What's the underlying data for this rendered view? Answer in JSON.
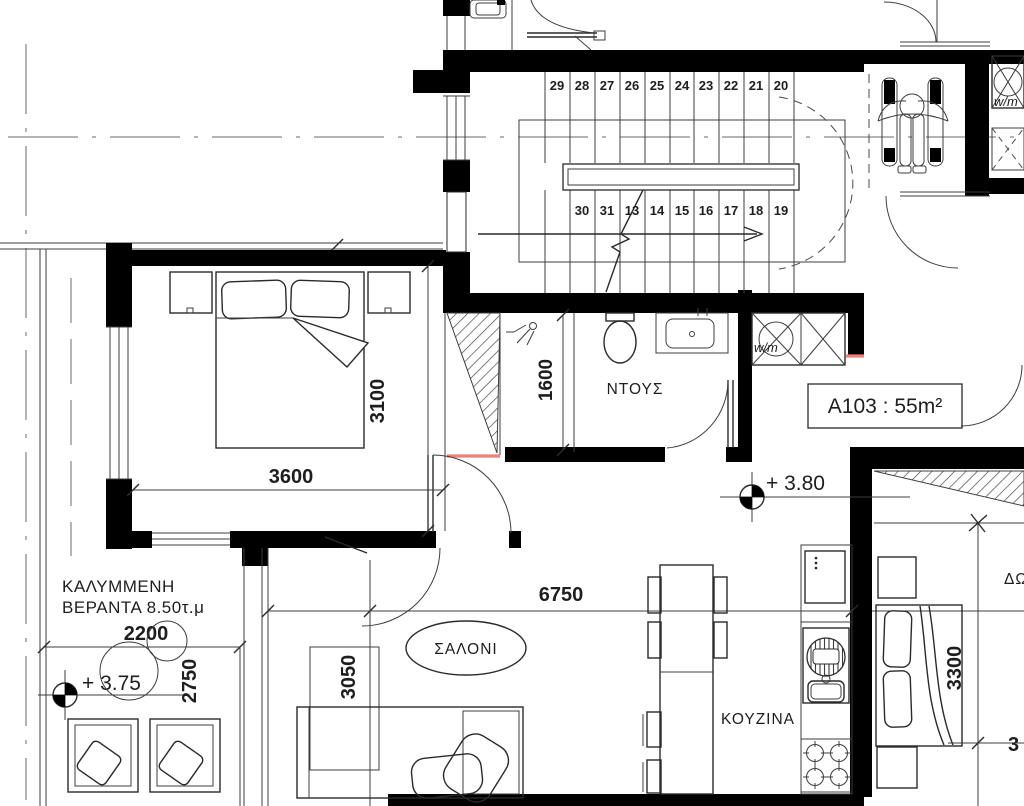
{
  "unit": {
    "label": "A103 : 55m²"
  },
  "levels": {
    "hall": "+ 3.80",
    "veranda": "+ 3.75"
  },
  "rooms": {
    "shower": "ΝΤΟΥΣ",
    "living": "ΣΑΛΟΝΙ",
    "kitchen": "ΚΟΥΖΙΝΑ",
    "veranda_line1": "ΚΑΛΥΜΜΕΝΗ",
    "veranda_line2": "ΒΕΡΑΝΤΑ 8.50τ.μ",
    "adjacent_room_partial": "ΔΩ"
  },
  "appliances": {
    "washer_closet": "w/m",
    "washer_top_right": "w/m"
  },
  "stairs": {
    "top_row": [
      "29",
      "28",
      "27",
      "26",
      "25",
      "24",
      "23",
      "22",
      "21",
      "20"
    ],
    "bottom_row": [
      "30",
      "31",
      "13",
      "14",
      "15",
      "16",
      "17",
      "18",
      "19"
    ]
  },
  "dims": {
    "bedroom_width": "3600",
    "bedroom_depth": "3100",
    "shower_depth": "1600",
    "veranda_width": "2200",
    "veranda_depth": "2750",
    "living_width": "6750",
    "living_depth": "3050",
    "bedroom2_depth": "3300",
    "right_partial": "3"
  },
  "colors": {
    "wall": "#000000",
    "line": "#3d3d3d",
    "accent_red": "#ef8079",
    "text": "#1e1e1e"
  }
}
